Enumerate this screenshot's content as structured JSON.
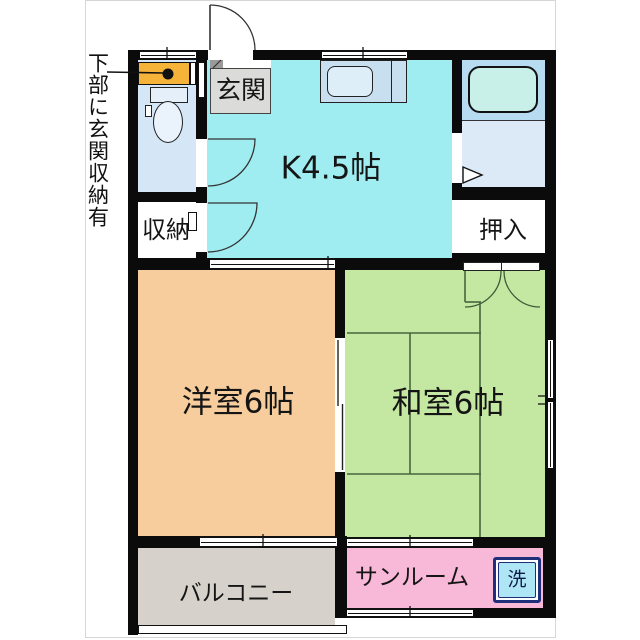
{
  "floorplan": {
    "annotation": "下部に玄関収納有",
    "rooms": {
      "entrance": "玄関",
      "kitchen": "K4.5帖",
      "storage": "収納",
      "oshiire": "押入",
      "western_room": "洋室6帖",
      "japanese_room": "和室6帖",
      "balcony": "バルコニー",
      "sunroom": "サンルーム",
      "washer": "洗"
    },
    "fixtures": {
      "toilet": "toilet",
      "bathtub": "bathtub",
      "kitchen_sink": "kitchen-sink",
      "entrance_storage": "entrance-storage-cabinet",
      "washing_machine_space": "washing-machine-space"
    },
    "colors": {
      "kitchen": "#a0edf1",
      "western_room": "#f7cd9d",
      "japanese_room": "#c4e8a2",
      "sunroom": "#f8b8d8",
      "balcony": "#d6d2cb",
      "entrance": "#dbdbd9",
      "toilet_room": "#d5e7f6",
      "bathroom": "#b7dbf1",
      "washroom": "#dceaf7",
      "cabinet": "#f5b33a",
      "washer_box": "#aee6f5",
      "washer_border": "#1f2f7a",
      "wall": "#0b0b0b"
    }
  }
}
